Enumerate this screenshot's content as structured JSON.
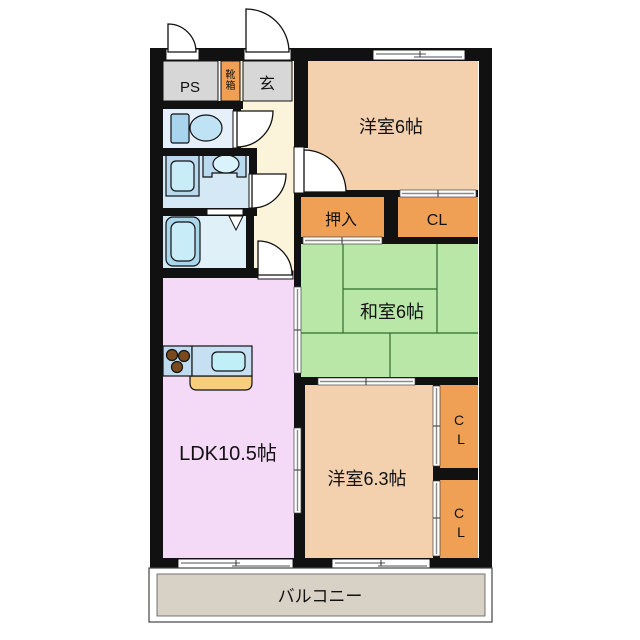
{
  "plan": {
    "rooms": {
      "ps": "PS",
      "shoebox_chars": [
        "靴",
        "箱"
      ],
      "entrance": "玄",
      "western_6": "洋室6帖",
      "oshiire": "押入",
      "closet_top": "CL",
      "japanese_6": "和室6帖",
      "ldk": "LDK10.5帖",
      "western_6_3": "洋室6.3帖",
      "closet_right_upper_chars": [
        "C",
        "L"
      ],
      "closet_right_lower_chars": [
        "C",
        "L"
      ],
      "balcony": "バルコニー"
    },
    "colors": {
      "wall": "#111111",
      "western_room": "#f3d0ae",
      "japanese_room": "#b9e7a8",
      "tatami_line": "#2f6b2f",
      "ldk": "#f5daf8",
      "closet": "#f0a055",
      "hallway": "#fbf4da",
      "service_gray": "#d7d7d7",
      "toilet_room": "#e6f0fa",
      "wet_room": "#d4e9f5",
      "shower_area": "#dff0f9",
      "fixture_blue": "#b9d9ef",
      "fixture_inner": "#c8edf8",
      "counter_base": "#f6ce7e",
      "burner": "#7a4a1e",
      "balcony": "#d8d1c6",
      "closet_text": "#6e2a1e"
    }
  }
}
